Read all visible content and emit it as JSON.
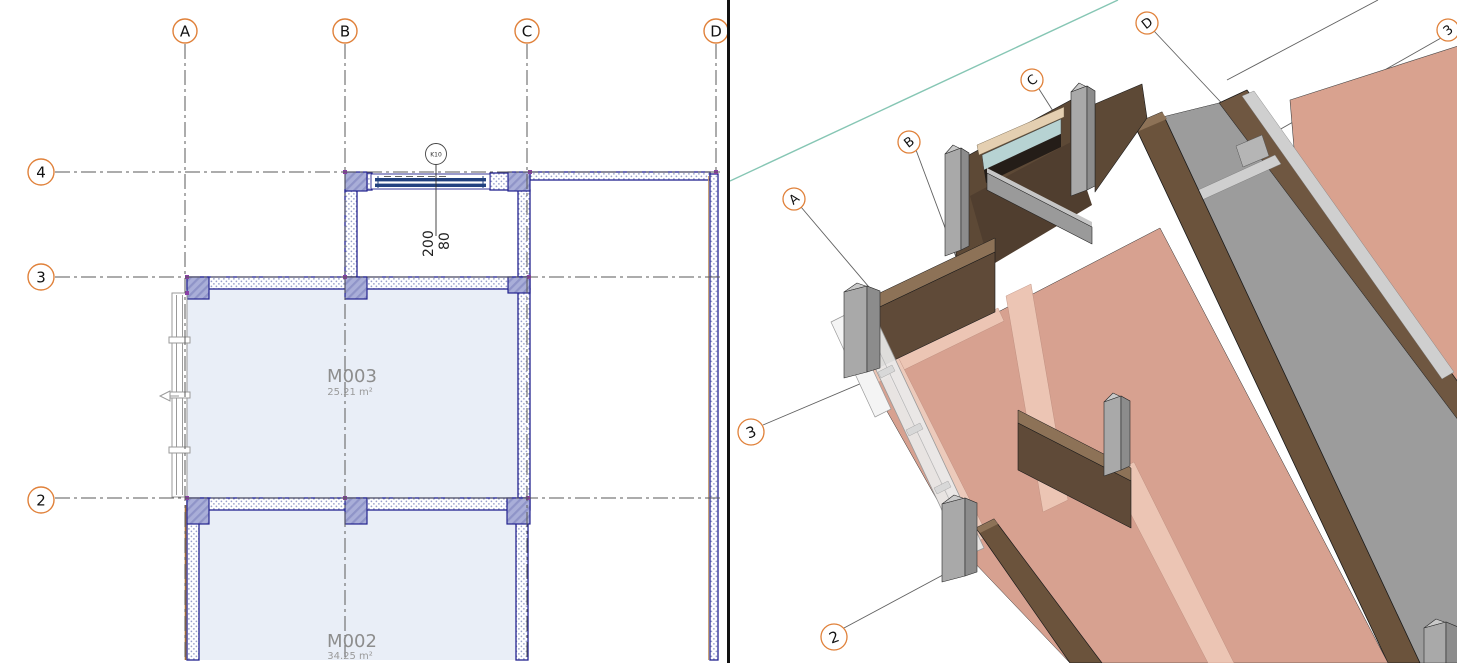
{
  "plan_view": {
    "grid_columns": [
      "A",
      "B",
      "C",
      "D"
    ],
    "grid_rows": [
      "4",
      "3",
      "2"
    ],
    "rooms": [
      {
        "name": "M003",
        "area": "25.21 m²"
      },
      {
        "name": "M002",
        "area": "34.25 m²"
      }
    ],
    "window_tag": "K10",
    "window_dimensions": {
      "width": "200",
      "height": "80"
    }
  },
  "view_3d": {
    "grid_letter_bubbles": [
      "A",
      "B",
      "C",
      "D"
    ],
    "grid_number_bubbles": [
      "3",
      "2"
    ],
    "edge_bubble": "3"
  },
  "colors": {
    "grid_bubble_orange": "#e0813a",
    "wall_line_blue": "#23238f",
    "room_fill": "#e9eef7",
    "floor_pink": "#d7a190",
    "wall_brown": "#6b533c",
    "column_gray": "#a9a9a9",
    "glass_teal": "#b7d3d3",
    "section_line_teal": "#86c6b4"
  }
}
